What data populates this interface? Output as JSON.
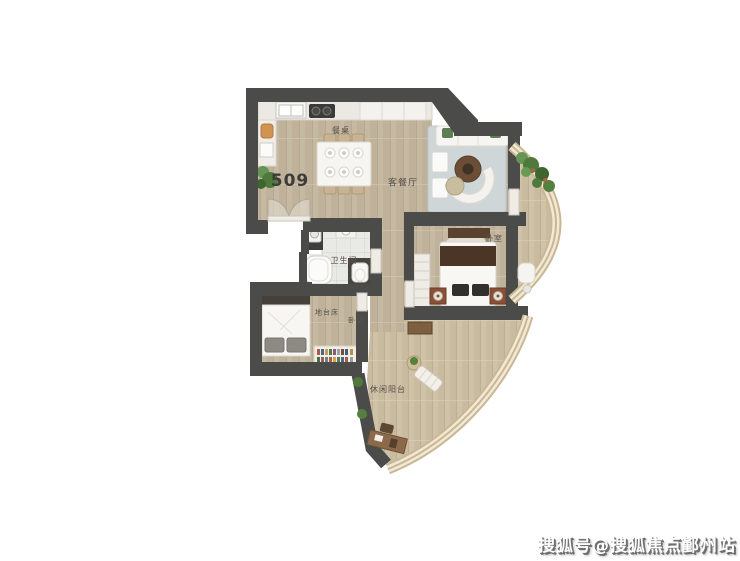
{
  "unit": {
    "number": "509"
  },
  "rooms": {
    "dining_table": "餐桌",
    "living_dining": "客餐厅",
    "bathroom": "卫生间",
    "master_bedroom": "卧室",
    "bedroom_second": "卧室",
    "platform_bed": "地台床",
    "leisure_balcony": "休闲阳台"
  },
  "watermark": {
    "text": "搜狐号@搜狐焦点鄞州站"
  },
  "colors": {
    "wall": "#4b4b49",
    "wood_floor": "#c6b9a2",
    "balcony_floor": "#cfc2a8",
    "tile": "#e9e9e5",
    "rug": "#ced6d8",
    "railing": "#c9b794",
    "railing_light": "#f1e9d6",
    "plant": "#4f7a3c",
    "dark_wood": "#5e4631",
    "background": "#ffffff"
  }
}
